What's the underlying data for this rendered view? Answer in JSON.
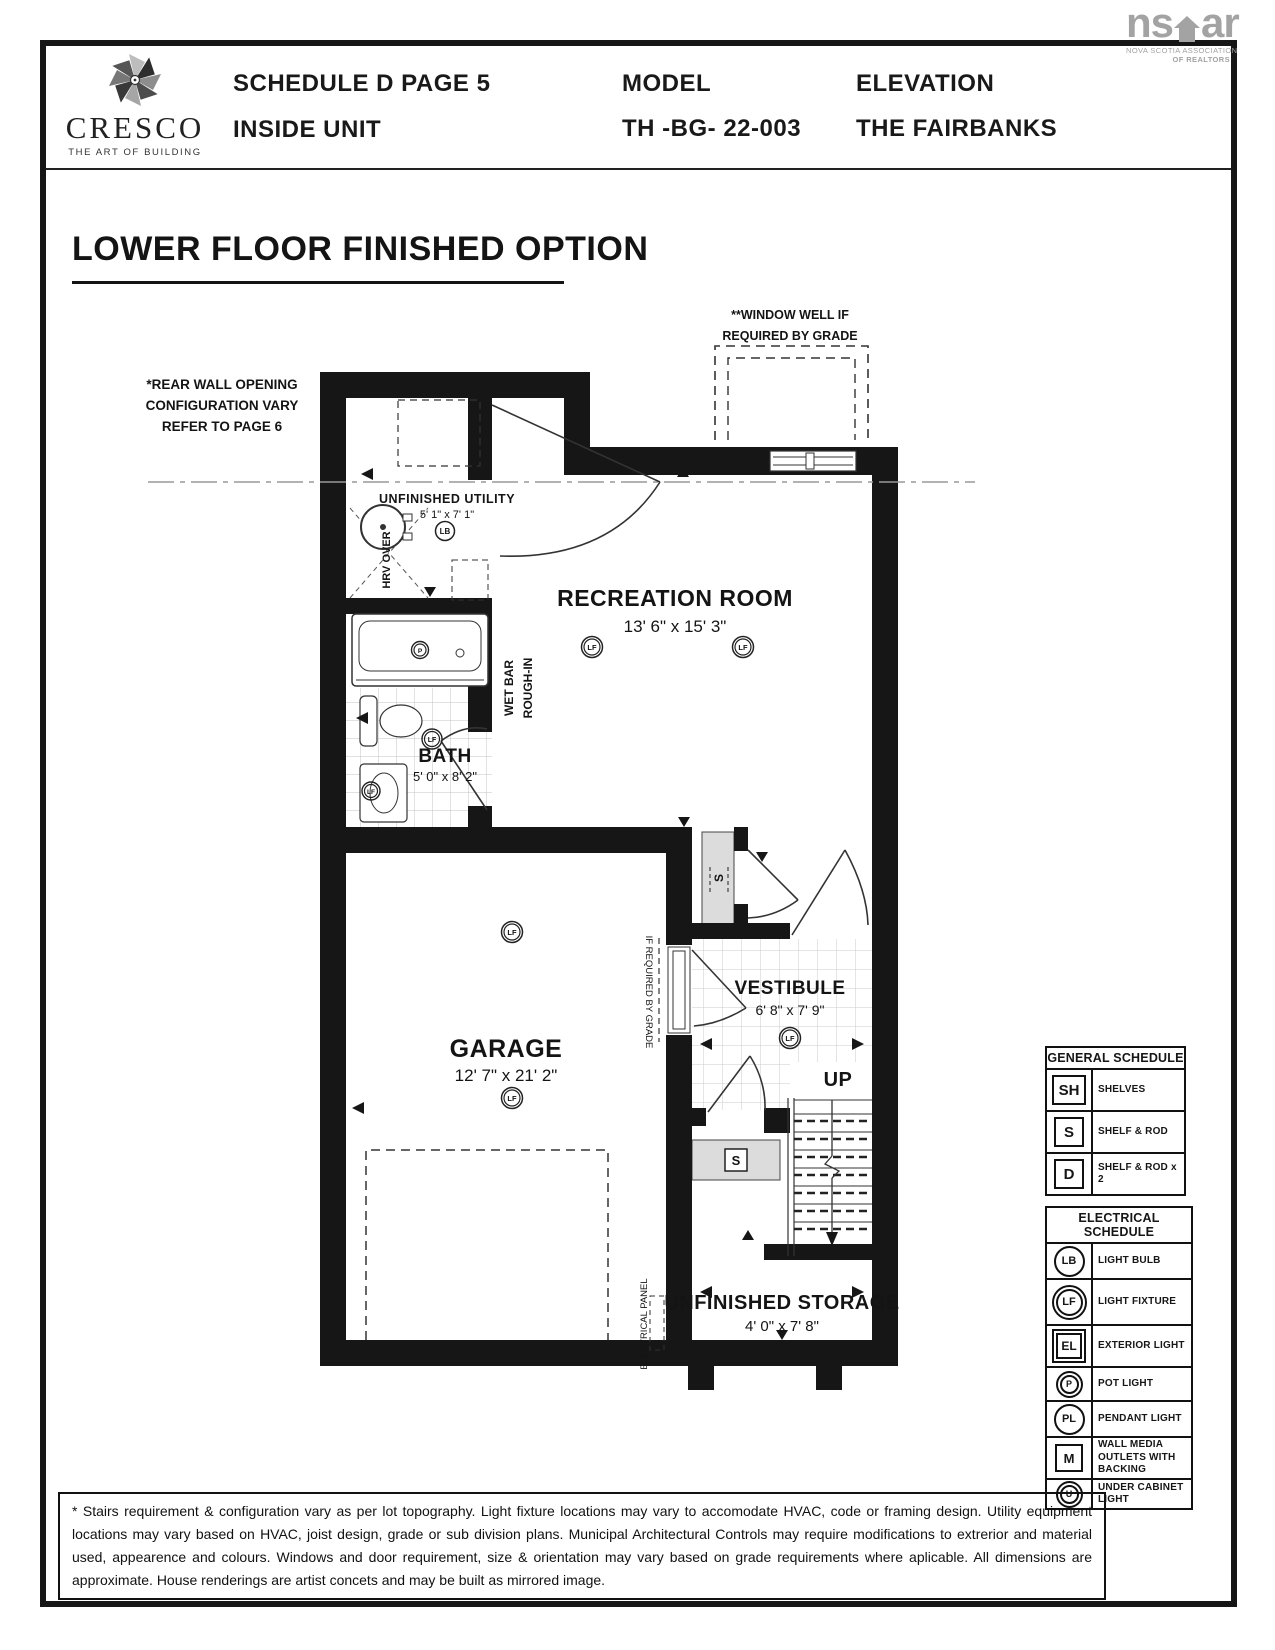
{
  "header": {
    "brand_name": "CRESCO",
    "brand_tagline": "THE ART OF BUILDING",
    "schedule": "SCHEDULE D PAGE 5",
    "unit": "INSIDE UNIT",
    "model_label": "MODEL",
    "model": "TH -BG- 22-003",
    "elevation_label": "ELEVATION",
    "elevation": "THE FAIRBANKS",
    "nsar_ns": "ns",
    "nsar_ar": "ar",
    "nsar_sub1": "NOVA SCOTIA ASSOCIATION",
    "nsar_sub2": "OF REALTORS"
  },
  "title": "LOWER FLOOR FINISHED OPTION",
  "plan": {
    "notes": {
      "rear1": "*REAR WALL OPENING",
      "rear2": "CONFIGURATION VARY",
      "rear3": "REFER TO PAGE 6",
      "well1": "**WINDOW WELL IF",
      "well2": "REQUIRED BY GRADE",
      "wetbar1": "WET BAR",
      "wetbar2": "ROUGH-IN",
      "grade": "IF REQUIRED BY GRADE",
      "panel": "ELECTRICAL PANEL",
      "hrv": "HRV OVER",
      "up": "UP"
    },
    "rooms": {
      "utility": {
        "name": "UNFINISHED UTILITY",
        "dims": "5' 1\" x 7' 1\""
      },
      "rec": {
        "name": "RECREATION ROOM",
        "dims": "13' 6\" x 15' 3\""
      },
      "bath": {
        "name": "BATH",
        "dims": "5' 0\" x 8' 2\""
      },
      "garage": {
        "name": "GARAGE",
        "dims": "12' 7\" x 21' 2\""
      },
      "vestibule": {
        "name": "VESTIBULE",
        "dims": "6' 8\" x 7' 9\""
      },
      "storage": {
        "name": "UNFINISHED STORAGE",
        "dims": "4' 0\" x 7' 8\""
      }
    },
    "symbols": {
      "lb": "LB",
      "lf": "LF",
      "p": "P",
      "s": "S"
    }
  },
  "general_schedule": {
    "title": "GENERAL SCHEDULE",
    "rows": [
      {
        "sym": "SH",
        "label": "SHELVES"
      },
      {
        "sym": "S",
        "label": "SHELF & ROD"
      },
      {
        "sym": "D",
        "label": "SHELF & ROD x 2"
      }
    ]
  },
  "electrical_schedule": {
    "title": "ELECTRICAL SCHEDULE",
    "rows": [
      {
        "sym": "LB",
        "label": "LIGHT BULB"
      },
      {
        "sym": "LF",
        "label": "LIGHT FIXTURE"
      },
      {
        "sym": "EL",
        "label": "EXTERIOR LIGHT"
      },
      {
        "sym": "P",
        "label": "POT LIGHT"
      },
      {
        "sym": "PL",
        "label": "PENDANT LIGHT"
      },
      {
        "sym": "M",
        "label": "WALL MEDIA OUTLETS WITH BACKING"
      },
      {
        "sym": "U",
        "label": "UNDER CABINET LIGHT"
      }
    ]
  },
  "footer": {
    "text": "* Stairs requirement & configuration vary as per lot topography. Light fixture locations may vary to accomodate HVAC, code or framing design. Utility equipment locations may vary based on HVAC, joist design, grade or sub division plans. Municipal Architectural Controls may require modifications to extrerior and material used, appearence and colours. Windows and door requirement, size & orientation may vary based on grade requirements where aplicable. All dimensions are approximate. House renderings are artist concets and may be built as mirrored image."
  }
}
